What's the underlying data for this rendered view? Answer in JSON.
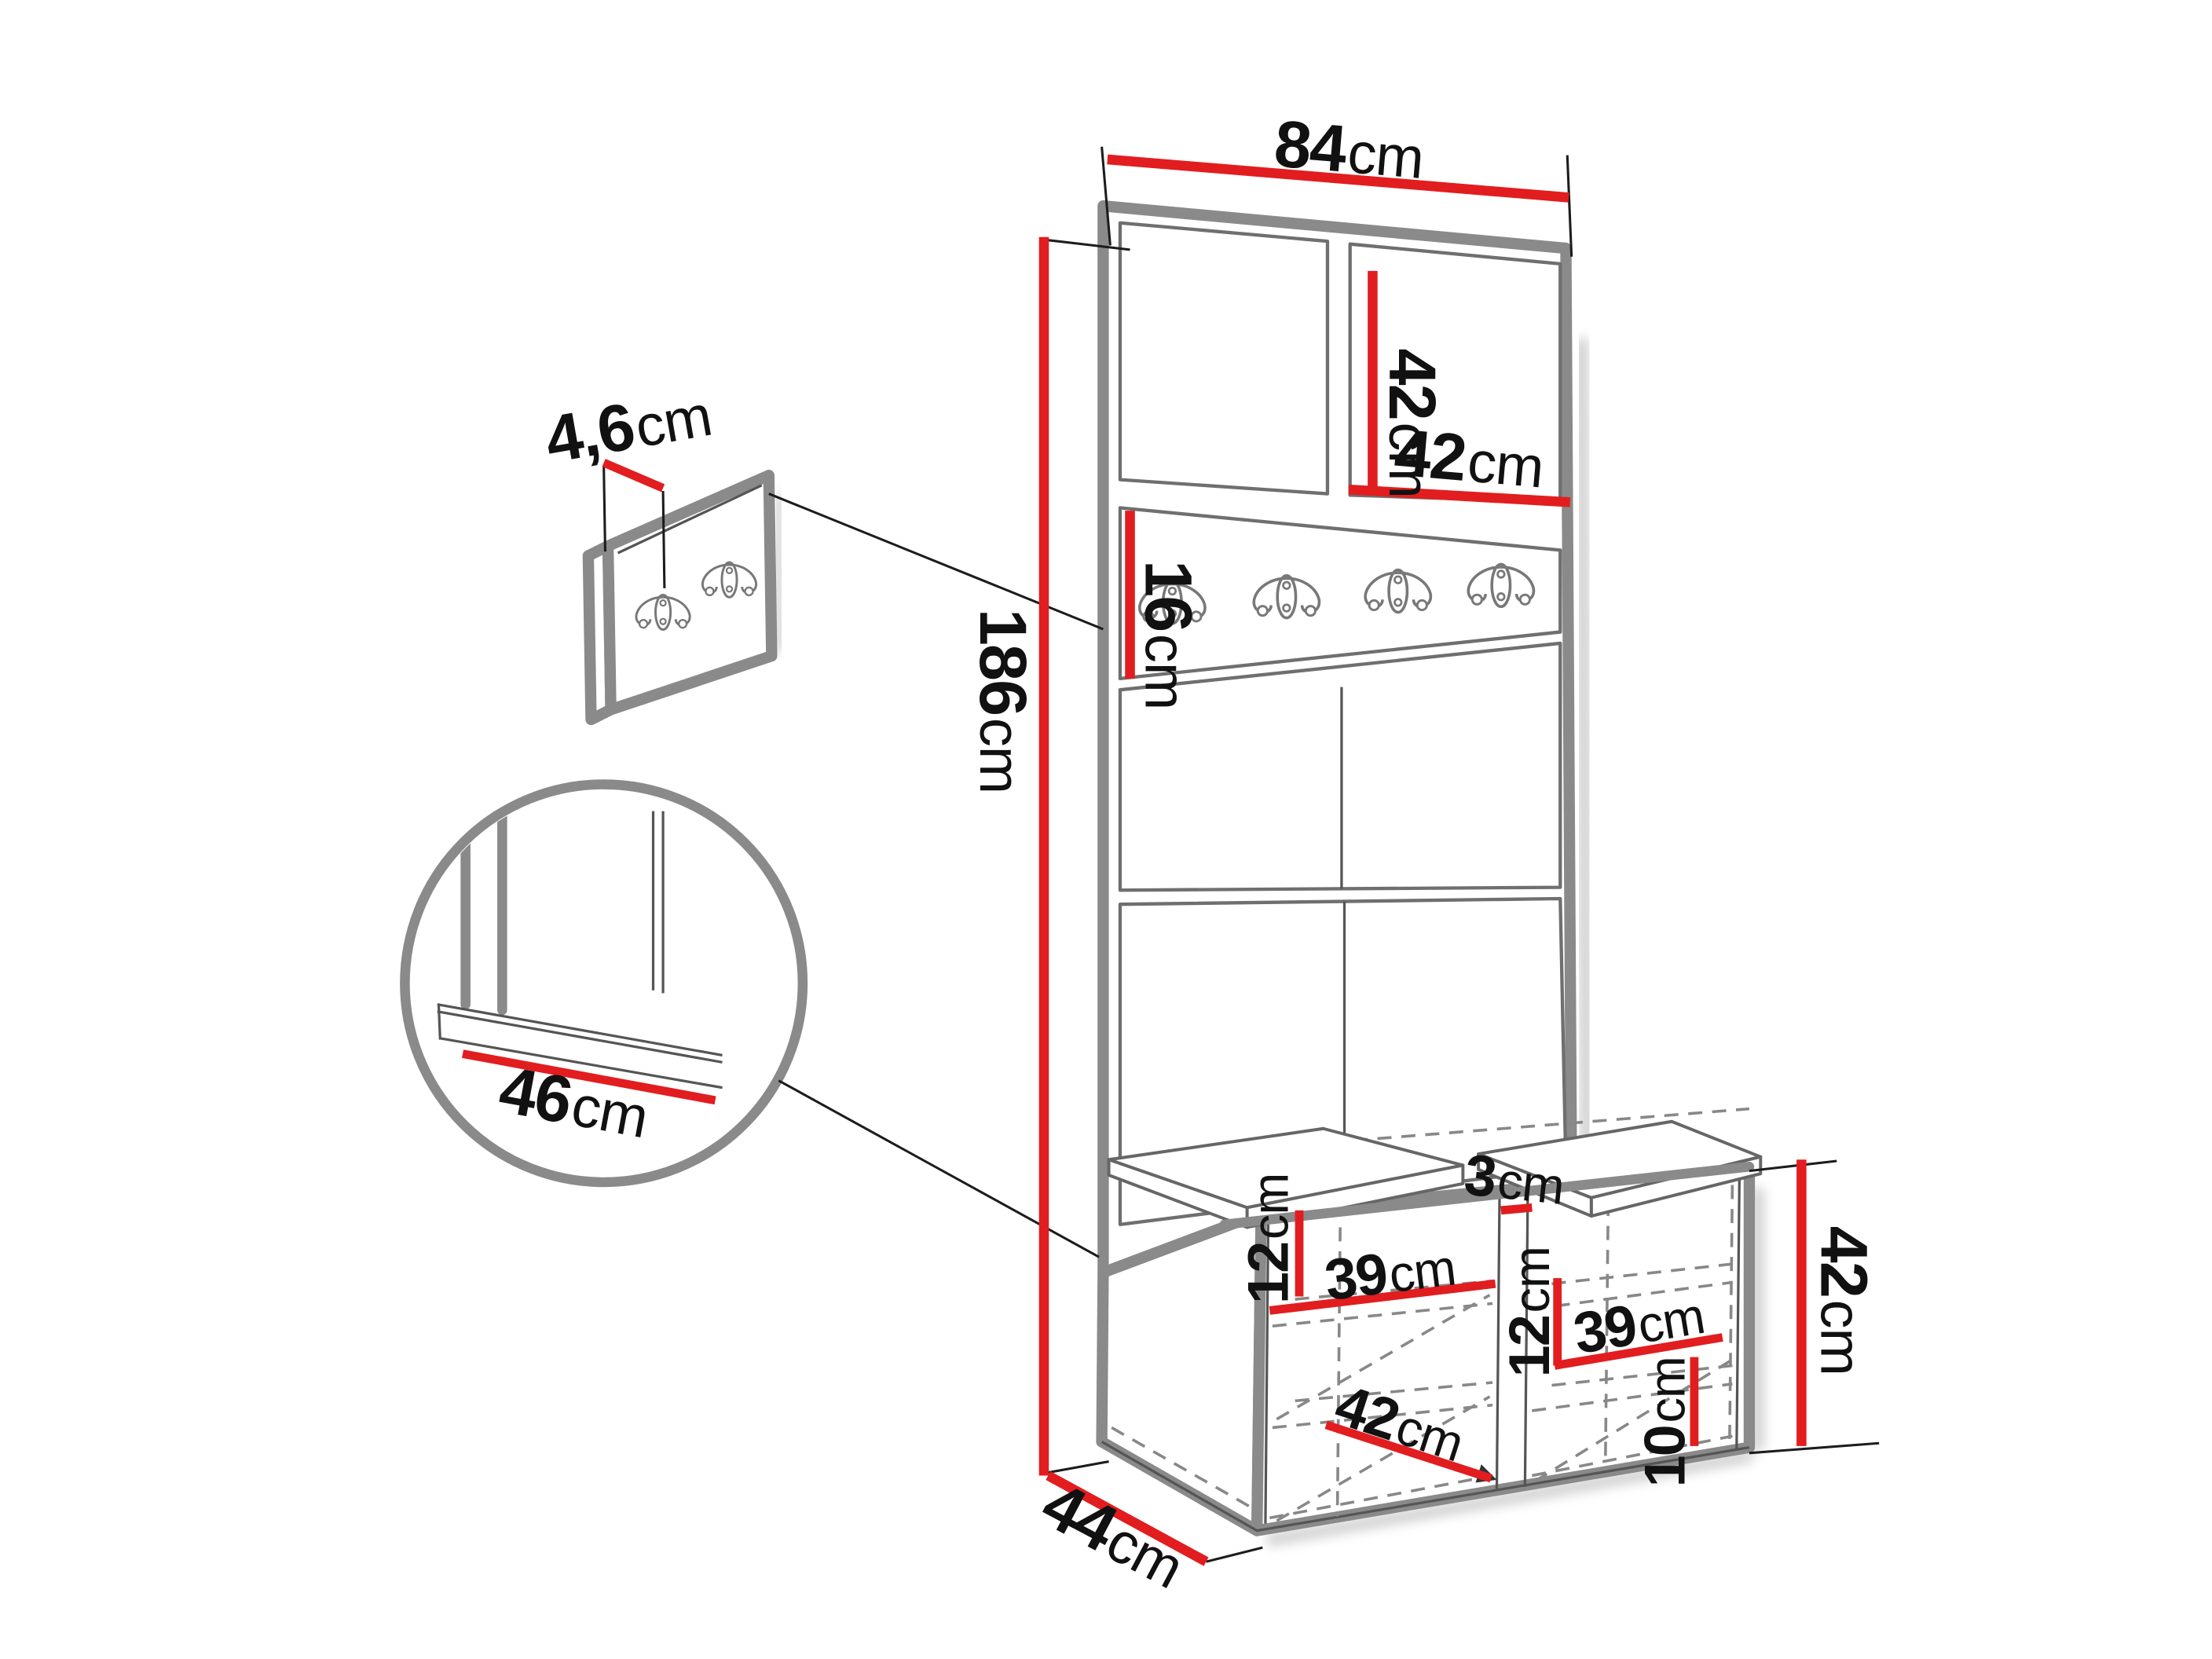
{
  "diagram": {
    "type": "furniture-dimension-diagram",
    "background": "#ffffff",
    "colors": {
      "dimension_red": "#e21d1f",
      "furniture_gray": "#8a8a8a",
      "detail_gray": "#666666",
      "dashed_gray": "#888888",
      "text_black": "#111111"
    },
    "dimensions": {
      "top_width": {
        "value": "84",
        "unit": "cm"
      },
      "top_panel_height": {
        "value": "42",
        "unit": "cm"
      },
      "top_panel_width": {
        "value": "42",
        "unit": "cm"
      },
      "hook_rail_height": {
        "value": "16",
        "unit": "cm"
      },
      "panel_thickness": {
        "value": "4,6",
        "unit": "cm"
      },
      "total_height": {
        "value": "186",
        "unit": "cm"
      },
      "seat_width": {
        "value": "46",
        "unit": "cm"
      },
      "left_shelf_spacing": {
        "value": "12",
        "unit": "cm"
      },
      "left_shelf_width": {
        "value": "39",
        "unit": "cm"
      },
      "cabinet_gap": {
        "value": "3",
        "unit": "cm"
      },
      "right_shelf_spacing": {
        "value": "12",
        "unit": "cm"
      },
      "right_shelf_width": {
        "value": "39",
        "unit": "cm"
      },
      "compartment_width": {
        "value": "42",
        "unit": "cm"
      },
      "plinth_height": {
        "value": "10",
        "unit": "cm"
      },
      "bench_height": {
        "value": "42",
        "unit": "cm"
      },
      "bench_depth": {
        "value": "44",
        "unit": "cm"
      }
    },
    "hooks": {
      "rail_hook_count": 4,
      "wall_panel_hook_count": 2
    }
  }
}
